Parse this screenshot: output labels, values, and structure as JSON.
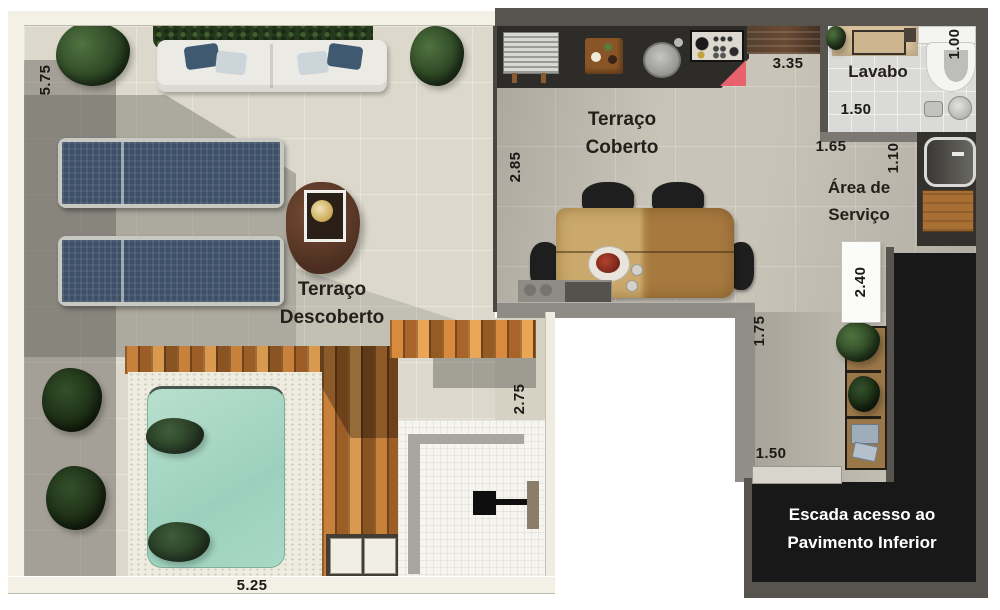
{
  "rooms": {
    "coberto": {
      "l1": "Terraço",
      "l2": "Coberto"
    },
    "descoberto": {
      "l1": "Terraço",
      "l2": "Descoberto"
    },
    "lavabo": {
      "l1": "Lavabo"
    },
    "servico": {
      "l1": "Área de",
      "l2": "Serviço"
    },
    "escada": {
      "l1": "Escada acesso ao",
      "l2": "Pavimento Inferior"
    }
  },
  "dims": {
    "left_wall_height": "5.75",
    "pool_side_width": "5.25",
    "coberto_depth": "2.85",
    "coberto_width": "3.35",
    "lavabo_width": "1.50",
    "lavabo_depth": "1.00",
    "servico_width": "1.65",
    "servico_depth": "1.10",
    "service_corridor_length": "2.40",
    "corridor_width": "1.75",
    "shower_depth": "2.75",
    "stair_landing_width": "1.50"
  },
  "colors": {
    "floor_beige": "#dcd8cb",
    "floor_gray": "#c9c4b8",
    "wall_dark": "#57544f",
    "wall_light": "#f3f0e5",
    "counter_black": "#2e2c29",
    "stair_black": "#181818",
    "pool_water": "#a9d6c6",
    "deck_wood": "#bf7a35",
    "lounge_navy": "#3e5068",
    "accent_red": "#e8626d"
  }
}
